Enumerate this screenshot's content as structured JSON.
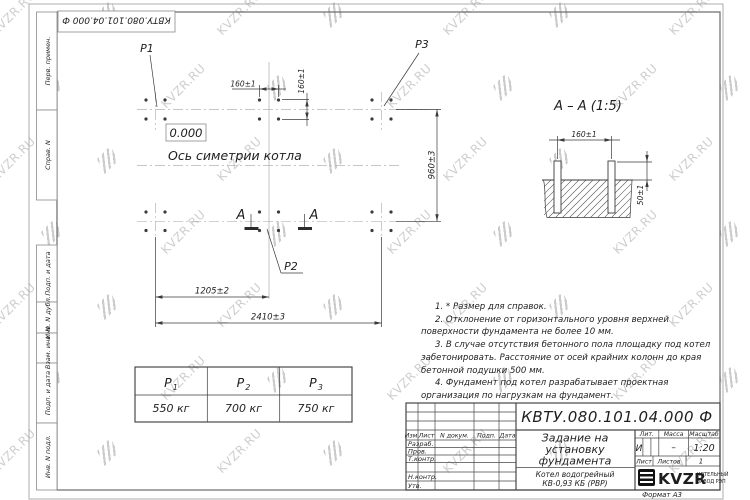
{
  "watermark": {
    "text": "KVZR.RU"
  },
  "frame": {
    "stamp_designation": "КВТУ.080.101.04.000  Ф",
    "left_labels": [
      "Перв. примен.",
      "Справ. N",
      "Подп. и дата",
      "Инв. N дубл.",
      "Взам. инв. N",
      "Подп. и дата",
      "Инв. N подл."
    ],
    "format_note": "Формат А3"
  },
  "plan": {
    "p1": "P1",
    "p2": "P2",
    "p3": "P3",
    "elevation": "0.000",
    "axis_label": "Ось симетрии котла",
    "dim_160_top": "160±1",
    "dim_160_side": "160±1",
    "dim_960": "960±3",
    "dim_1205": "1205±2",
    "dim_2410": "2410±3",
    "section_letter_left": "А",
    "section_letter_right": "А"
  },
  "section_view": {
    "title": "А – А (1:5)",
    "dim_160": "160±1",
    "dim_50": "50±1"
  },
  "load_table": {
    "headers": [
      {
        "base": "P",
        "sub": "1"
      },
      {
        "base": "P",
        "sub": "2"
      },
      {
        "base": "P",
        "sub": "3"
      }
    ],
    "values": [
      "550 кг",
      "700 кг",
      "750 кг"
    ]
  },
  "notes": [
    "1.  * Размер для справок.",
    "2.  Отклонение от горизонтального уровня верхней поверхности фундамента не более 10 мм.",
    "3.  В случае отсутствия бетонного пола площадку под котел забетонировать. Расстояние от осей крайних колонн до края бетонной подушки 500 мм.",
    "4.  Фундамент под котел разрабатывает проектная организация по нагрузкам на фундамент."
  ],
  "title_block": {
    "designation": "КВТУ.080.101.04.000  Ф",
    "doc_title_lines": [
      "Задание на",
      "установку",
      "фундамента"
    ],
    "product_lines": [
      "Котел водогрейный",
      "КВ-0,93 КБ (РВР)"
    ],
    "header_cols": [
      "Изм.",
      "Лист",
      "N докум.",
      "Подп.",
      "Дата"
    ],
    "row_labels": [
      "Разраб.",
      "Пров.",
      "Т.контр.",
      "Н.контр.",
      "Утв."
    ],
    "lit_label": "Лит.",
    "lit_value": "И",
    "mass_label": "Масса",
    "mass_value": "–",
    "scale_label": "Масштаб",
    "scale_value": "1:20",
    "sheet_label": "Лист",
    "sheets_label": "Листов",
    "sheets_value": "1",
    "company": {
      "logo_text": "KVZR",
      "tagline_lines": [
        "КОТЕЛЬНЫЙ",
        "ЗАВОД РЭП"
      ]
    }
  }
}
